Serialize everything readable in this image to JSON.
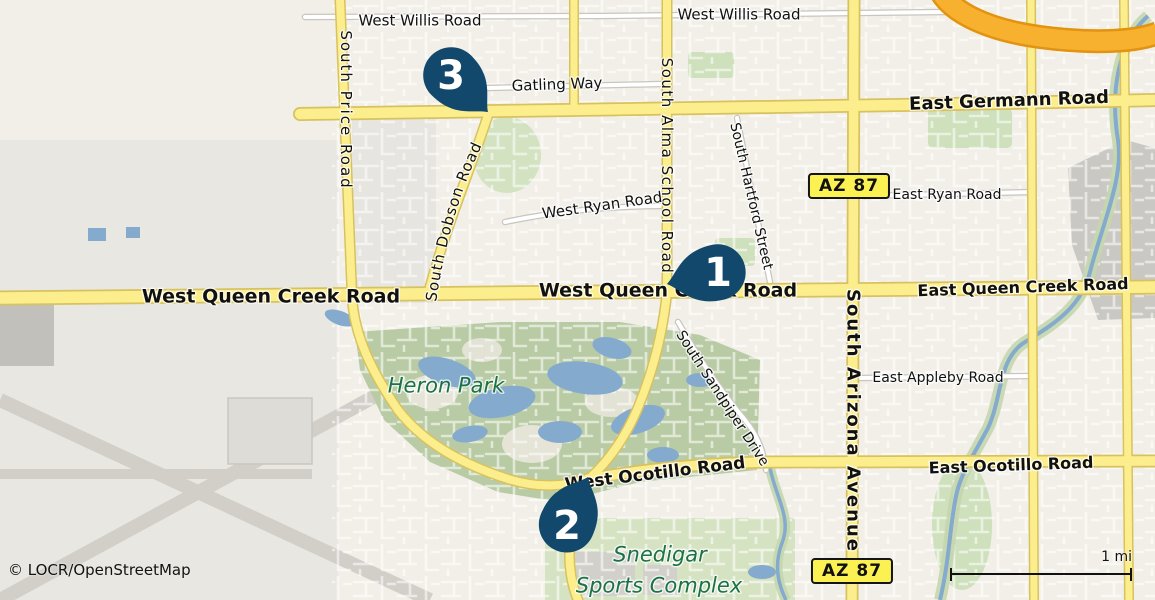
{
  "map": {
    "attribution": "© LOCR/OpenStreetMap",
    "scale_bar": {
      "label": "1 mi"
    },
    "shields": [
      {
        "id": "az87-north",
        "text": "AZ 87",
        "x": 849,
        "y": 186
      },
      {
        "id": "az87-south",
        "text": "AZ 87",
        "x": 852,
        "y": 571
      }
    ],
    "markers": [
      {
        "number": "1",
        "tip_x": 667,
        "tip_y": 284,
        "rotation": 77,
        "cx": 718,
        "cy": 272
      },
      {
        "number": "2",
        "tip_x": 588,
        "tip_y": 477,
        "rotation": -156,
        "cx": 567,
        "cy": 525
      },
      {
        "number": "3",
        "tip_x": 488,
        "tip_y": 112,
        "rotation": -45,
        "cx": 451,
        "cy": 75
      }
    ],
    "labels": [
      {
        "id": "west-willis-road-left",
        "text": "West Willis Road",
        "x": 420,
        "y": 20,
        "rot": 0,
        "size": 15
      },
      {
        "id": "west-willis-road-right",
        "text": "West Willis Road",
        "x": 739,
        "y": 14,
        "rot": 0,
        "size": 15
      },
      {
        "id": "gatling-way",
        "text": "Gatling Way",
        "x": 557,
        "y": 84,
        "rot": -2,
        "size": 15
      },
      {
        "id": "east-germann-road",
        "text": "East Germann Road",
        "x": 1009,
        "y": 100,
        "rot": -2,
        "size": 18,
        "bold": true
      },
      {
        "id": "south-price-road",
        "text": "South Price Road",
        "x": 346,
        "y": 110,
        "rot": 90,
        "size": 15,
        "spacing": 2
      },
      {
        "id": "south-dobson-road",
        "text": "South Dobson Road",
        "path": "dobson-label-path",
        "size": 15,
        "spacing": 1
      },
      {
        "id": "south-alma-school-road",
        "text": "South Alma School Road",
        "x": 667,
        "y": 166,
        "rot": 90,
        "size": 15,
        "spacing": 1.5
      },
      {
        "id": "west-ryan-road",
        "text": "West Ryan Road",
        "x": 602,
        "y": 205,
        "rot": -8,
        "size": 15
      },
      {
        "id": "south-hartford-street",
        "text": "South Hartford Street",
        "x": 752,
        "y": 196,
        "rot": 77,
        "size": 14
      },
      {
        "id": "east-ryan-road",
        "text": "East Ryan Road",
        "x": 947,
        "y": 194,
        "rot": 0,
        "size": 14
      },
      {
        "id": "west-queen-creek-road-left",
        "text": "West Queen Creek Road",
        "x": 271,
        "y": 296,
        "rot": 0,
        "size": 19,
        "bold": true
      },
      {
        "id": "west-queen-creek-road-center",
        "text": "West Queen Creek Road",
        "x": 668,
        "y": 290,
        "rot": 0,
        "size": 19,
        "bold": true
      },
      {
        "id": "east-queen-creek-road",
        "text": "East Queen Creek Road",
        "x": 1023,
        "y": 287,
        "rot": -2,
        "size": 16,
        "bold": true
      },
      {
        "id": "south-arizona-avenue",
        "text": "South Arizona Avenue",
        "x": 854,
        "y": 421,
        "rot": 90,
        "size": 18,
        "bold": true,
        "spacing": 2
      },
      {
        "id": "east-appleby-road",
        "text": "East Appleby Road",
        "x": 938,
        "y": 377,
        "rot": 0,
        "size": 14
      },
      {
        "id": "south-sandpiper-drive",
        "text": "South Sandpiper Drive",
        "x": 723,
        "y": 398,
        "rot": 57,
        "size": 14
      },
      {
        "id": "west-ocotillo-road",
        "text": "West Ocotillo Road",
        "x": 655,
        "y": 473,
        "rot": -7,
        "size": 17,
        "bold": true
      },
      {
        "id": "east-ocotillo-road",
        "text": "East Ocotillo Road",
        "x": 1011,
        "y": 465,
        "rot": -2,
        "size": 16,
        "bold": true
      },
      {
        "id": "heron-park",
        "text": "Heron Park",
        "x": 446,
        "y": 385,
        "rot": 0,
        "size": 21,
        "italic": true,
        "color": "#1b7245"
      },
      {
        "id": "snedigar-line1",
        "text": "Snedigar",
        "x": 660,
        "y": 554,
        "rot": 0,
        "size": 21,
        "italic": true,
        "color": "#1b7245"
      },
      {
        "id": "snedigar-line2",
        "text": "Sports Complex",
        "x": 659,
        "y": 585,
        "rot": 0,
        "size": 21,
        "italic": true,
        "color": "#1b7245"
      }
    ],
    "colors": {
      "marker": "#12486b",
      "marker_text": "#ffffff",
      "road_yellow": "#fcee8d",
      "road_casing": "#d8c25f",
      "highway_orange": "#f8b12f",
      "highway_casing": "#e2930f",
      "land": "#f1efe7",
      "park": "#b9cba4",
      "park_light": "#cfe0bd",
      "water": "#84aacd",
      "airport": "#e9e7e1",
      "runway": "#d2cfc9",
      "industrial": "#cac8c2",
      "label_black": "#111111"
    }
  }
}
